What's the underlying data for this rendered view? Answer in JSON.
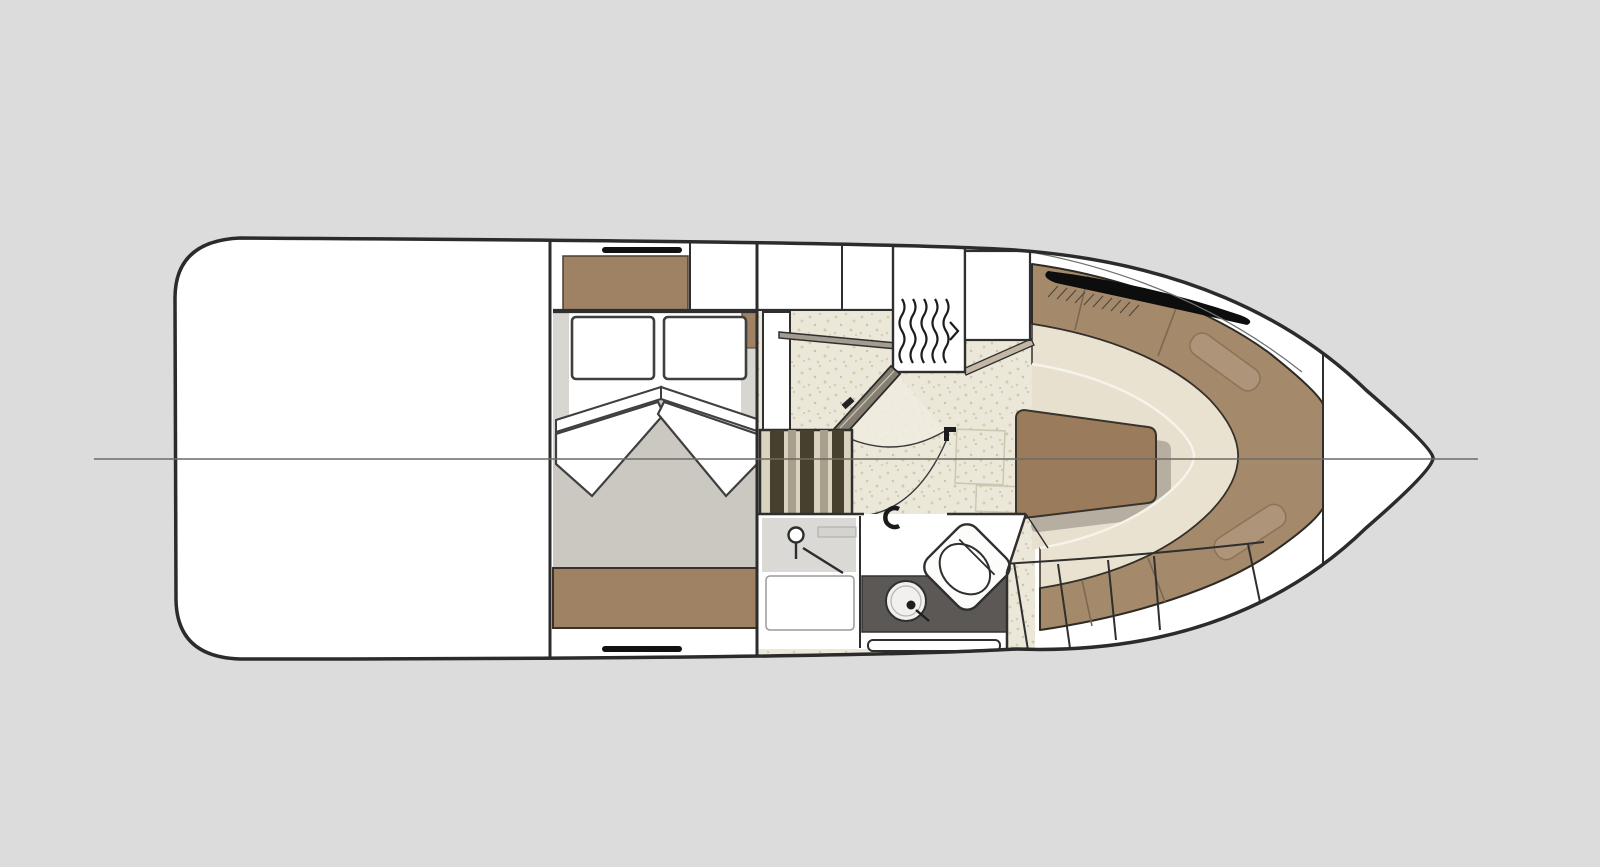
{
  "canvas": {
    "width": 1600,
    "height": 867,
    "background": "#dcdcdc"
  },
  "diagram": {
    "type": "boat-floor-plan",
    "rooms": [
      "cockpit",
      "mid-cabin",
      "galley-salon",
      "head-bathroom",
      "bow-dinette",
      "bow-storage"
    ],
    "features": [
      "centerline",
      "hull-outline",
      "companionway-stairs",
      "accordion-door",
      "double-berth",
      "shower",
      "sink",
      "toilet",
      "dinette-table",
      "bow-window",
      "storage-lockers"
    ]
  },
  "palette": {
    "background": "#dcdcdc",
    "hull_outline": "#2b2b2b",
    "hull_fill": "#ffffff",
    "wood_brown": "#9f8263",
    "upholstery_brown": "#a5896b",
    "seat_cream": "#e9e2d1",
    "floor_speckle_base": "#ebe7d9",
    "dinette_floor": "#e7e0cf",
    "mattress_gray": "#cbc8c2",
    "counter_dark": "#5b5855",
    "stair_dark": "#46402f",
    "stair_light": "#d9d2bf",
    "centerline_gray": "#6e6a64",
    "window_black": "#0d0d0d"
  }
}
